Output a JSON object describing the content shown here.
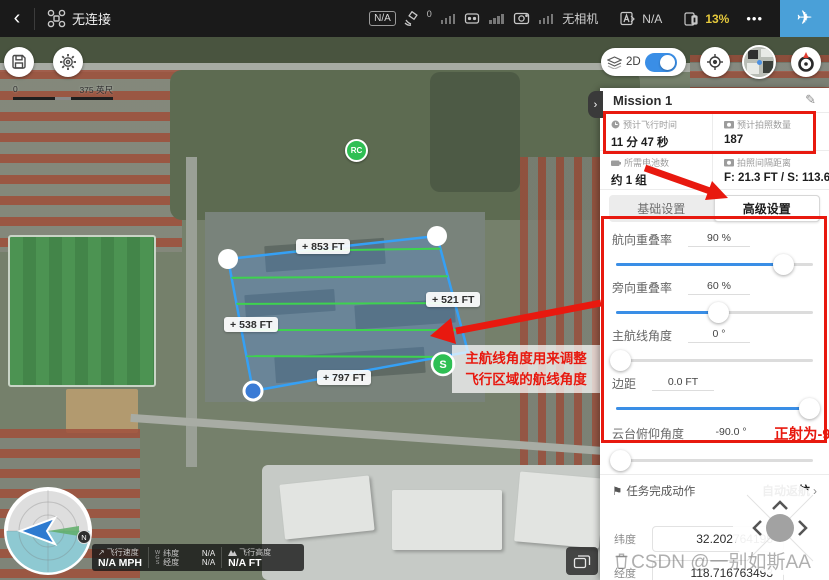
{
  "topbar": {
    "connection_status": "无连接",
    "flight_mode_badge": "N/A",
    "satellite_count": "0",
    "no_camera_label": "无相机",
    "rc_mode_value": "N/A",
    "battery_percent": "13%"
  },
  "map_controls": {
    "view_mode_label": "2D"
  },
  "map": {
    "scale_start": "0",
    "scale_end": "375 英尺",
    "rc_marker_label": "RC",
    "start_marker_label": "S",
    "distance_labels": [
      {
        "text": "853 FT"
      },
      {
        "text": "521 FT"
      },
      {
        "text": "538 FT"
      },
      {
        "text": "797 FT"
      }
    ],
    "annotation_line1": "主航线角度用来调整",
    "annotation_line2": "飞行区域的航线角度"
  },
  "telemetry": {
    "speed_label": "飞行速度",
    "speed_value": "N/A MPH",
    "datum_label": "WGS",
    "lat_label": "纬度",
    "lat_value": "N/A",
    "lng_label": "经度",
    "lng_value": "N/A",
    "alt_label": "飞行高度",
    "alt_value": "N/A FT"
  },
  "panel": {
    "title": "Mission 1",
    "stats": [
      {
        "label": "预计飞行时间",
        "value": "11 分 47 秒"
      },
      {
        "label": "预计拍照数量",
        "value": "187"
      },
      {
        "label": "所需电池数",
        "value": "约 1 组"
      },
      {
        "label": "拍照间隔距离",
        "value": "F: 21.3 FT / S: 113.6 FT"
      }
    ],
    "tabs": [
      {
        "label": "基础设置"
      },
      {
        "label": "高级设置"
      }
    ],
    "sliders": [
      {
        "label": "航向重叠率",
        "value": "90 %"
      },
      {
        "label": "旁向重叠率",
        "value": "60 %"
      },
      {
        "label": "主航线角度",
        "value": "0 °"
      },
      {
        "label": "边距",
        "value": "0.0 FT"
      },
      {
        "label": "云台俯仰角度",
        "value": "-90.0 °"
      }
    ],
    "gimbal_note": "正射为-90°",
    "finish_action_label": "任务完成动作",
    "finish_action_value": "自动返航",
    "coords": [
      {
        "label": "纬度",
        "value": "32.202764195"
      },
      {
        "label": "经度",
        "value": "118.716763493"
      }
    ]
  },
  "watermark": "CSDN @一别如斯AA",
  "glyphs": {
    "back": "‹",
    "ellipsis": "•••",
    "plane": "✈",
    "chevron_right": "›",
    "chevron_left": "‹",
    "chevron_up": "∧",
    "plus": "+",
    "arrow_ne": "↗",
    "pencil": "✎",
    "flag": "⚑"
  },
  "colors": {
    "accent_blue": "#3a8ee6",
    "takeoff_blue": "#4aa0d8",
    "annotation_red": "#e8190f",
    "battery_warning": "#e5c93c",
    "flight_line_green": "#3ed24f",
    "polygon_blue": "#35a0f5"
  }
}
